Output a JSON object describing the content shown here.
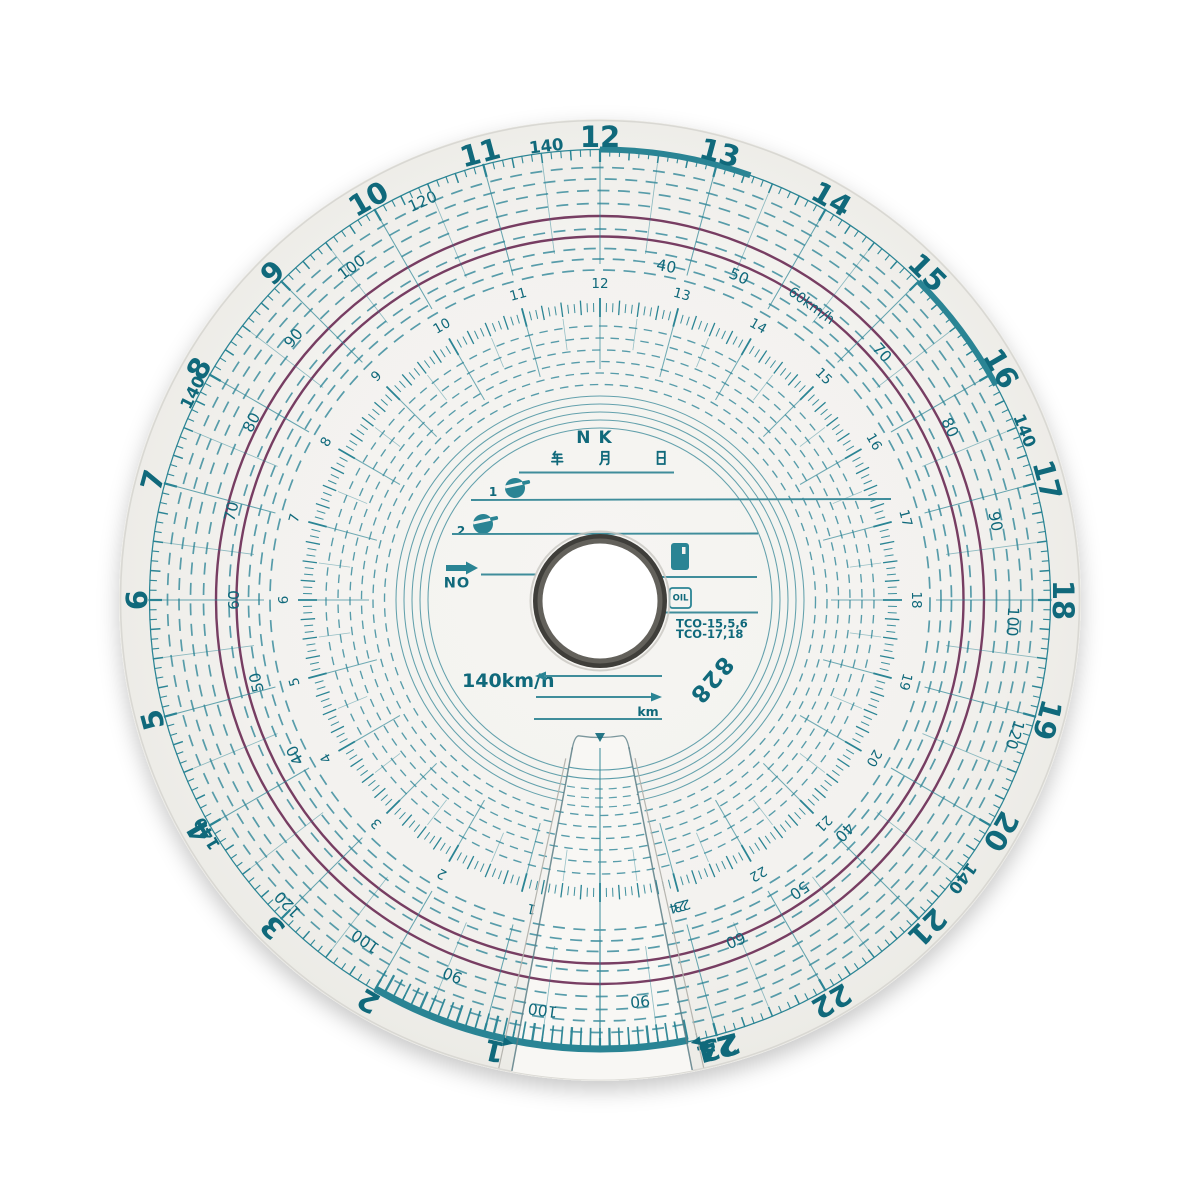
{
  "colors": {
    "teal": "#2a8494",
    "teal_dark": "#10697b",
    "teal_light": "#4e97a5",
    "teal_arc": "#3e8c9b",
    "purple": "#6c2e56",
    "paper": "#f3f2ef",
    "paper_flap": "#f8f7f4",
    "paper_edge": "#d9d8d3",
    "hole_ring_dark": "#3f3e3a",
    "hole_ring_light": "#63615b",
    "cut_edge": "#5d7f87",
    "slot_edge": "#b3b2ac"
  },
  "outer_ring": {
    "hours": [
      "1",
      "2",
      "3",
      "4",
      "5",
      "6",
      "7",
      "8",
      "9",
      "10",
      "11",
      "12",
      "13",
      "14",
      "15",
      "16",
      "17",
      "18",
      "19",
      "20",
      "21",
      "22",
      "23",
      "24"
    ],
    "max_speed_labels": [
      {
        "text": "140",
        "hour": 3.95
      },
      {
        "text": "140",
        "hour": 7.8
      },
      {
        "text": "140",
        "hour": 11.55
      },
      {
        "text": "140",
        "hour": 16.55
      },
      {
        "text": "140",
        "hour": 20.5
      }
    ]
  },
  "inner_ring": {
    "hours": [
      "1",
      "2",
      "3",
      "4",
      "5",
      "6",
      "7",
      "8",
      "9",
      "10",
      "11",
      "12",
      "13",
      "14",
      "15",
      "16",
      "17",
      "18",
      "19",
      "20",
      "21",
      "22",
      "23",
      "24"
    ]
  },
  "speed_scale": {
    "labels": [
      {
        "text": "40",
        "hour": 4.2,
        "r": 342
      },
      {
        "text": "50",
        "hour": 5.1,
        "r": 353
      },
      {
        "text": "60",
        "hour": 6.0,
        "r": 366
      },
      {
        "text": "70",
        "hour": 6.9,
        "r": 379
      },
      {
        "text": "80",
        "hour": 7.8,
        "r": 391
      },
      {
        "text": "90",
        "hour": 8.7,
        "r": 403
      },
      {
        "text": "100",
        "hour": 9.55,
        "r": 415
      },
      {
        "text": "120",
        "hour": 10.4,
        "r": 436
      },
      {
        "text": "40",
        "hour": 12.75,
        "r": 340
      },
      {
        "text": "50",
        "hour": 13.55,
        "r": 352
      },
      {
        "text": "60km/h",
        "hour": 14.38,
        "r": 362
      },
      {
        "text": "70",
        "hour": 15.25,
        "r": 375
      },
      {
        "text": "80",
        "hour": 16.25,
        "r": 390
      },
      {
        "text": "90",
        "hour": 17.25,
        "r": 403
      },
      {
        "text": "100",
        "hour": 18.2,
        "r": 413
      },
      {
        "text": "120",
        "hour": 19.2,
        "r": 436
      },
      {
        "text": "40",
        "hour": 20.9,
        "r": 337
      },
      {
        "text": "50",
        "hour": 21.7,
        "r": 352
      },
      {
        "text": "60",
        "hour": 22.55,
        "r": 366
      },
      {
        "text": "90",
        "hour": 1.43,
        "r": 403
      },
      {
        "text": "100",
        "hour": 2.3,
        "r": 414
      },
      {
        "text": "120",
        "hour": 3.05,
        "r": 436
      }
    ]
  },
  "flap": {
    "labels": [
      {
        "text": "100",
        "hour": 0.53,
        "r": 414
      },
      {
        "text": "90",
        "hour": 23.62,
        "r": 403
      }
    ]
  },
  "center_field": {
    "maker_label": "NK",
    "date_characters": [
      "年",
      "月",
      "日"
    ],
    "driver_rows": [
      "1",
      "2"
    ],
    "no_label": "NO",
    "oil_label": "OIL",
    "model_lines": [
      "TCO-15,5,6",
      "TCO-17,18"
    ],
    "max_speed_label": "140km/h",
    "distance_unit_label": "km",
    "chart_number": "828"
  }
}
